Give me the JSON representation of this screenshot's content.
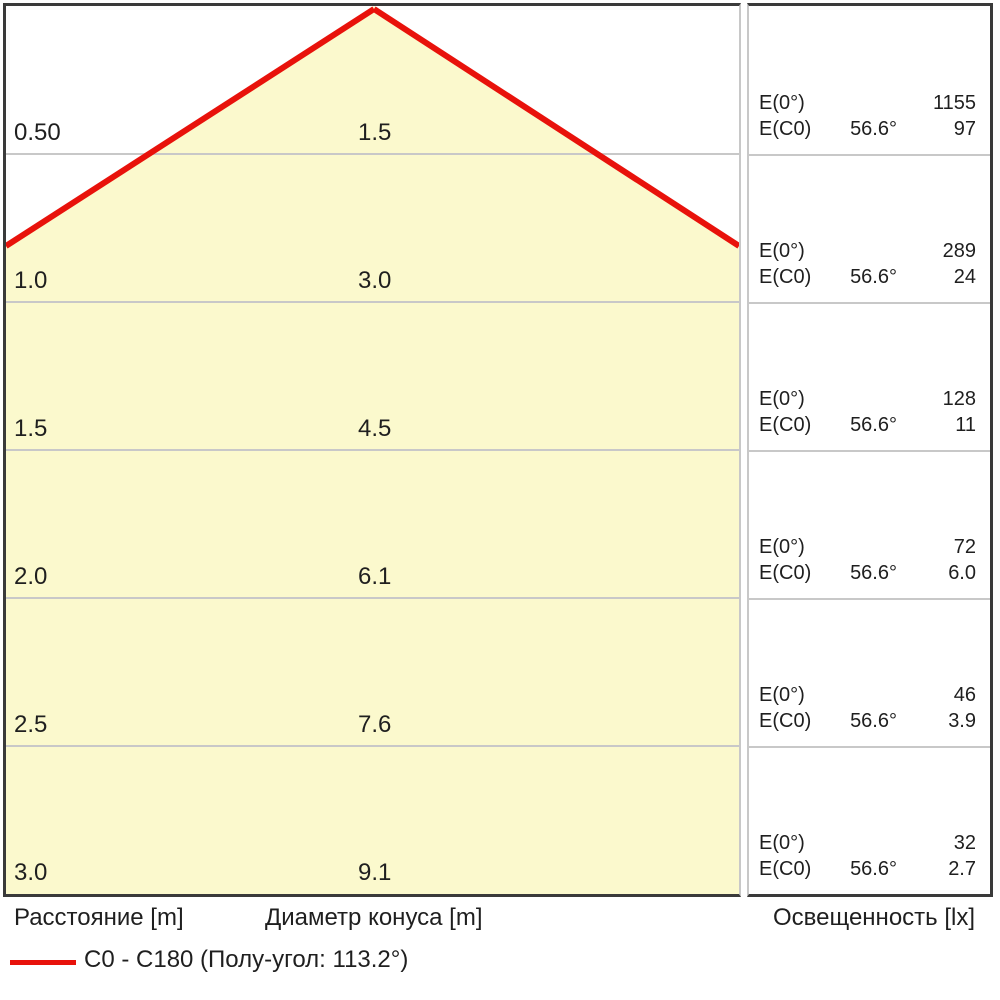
{
  "colors": {
    "cone_yellow": "#FBF9CD",
    "red": "#E8120B",
    "divider_gray": "#C8C8C8",
    "border_dark": "#3A3A3A",
    "text": "#1F1F1F"
  },
  "table": {
    "rows": [
      {
        "distance": "0.50",
        "diameter": "1.5",
        "e0_label": "E(0°)",
        "e0_value": "1155",
        "ec0_label": "E(C0)",
        "angle": "56.6°",
        "ec0_value": "97"
      },
      {
        "distance": "1.0",
        "diameter": "3.0",
        "e0_label": "E(0°)",
        "e0_value": "289",
        "ec0_label": "E(C0)",
        "angle": "56.6°",
        "ec0_value": "24"
      },
      {
        "distance": "1.5",
        "diameter": "4.5",
        "e0_label": "E(0°)",
        "e0_value": "128",
        "ec0_label": "E(C0)",
        "angle": "56.6°",
        "ec0_value": "11"
      },
      {
        "distance": "2.0",
        "diameter": "6.1",
        "e0_label": "E(0°)",
        "e0_value": "72",
        "ec0_label": "E(C0)",
        "angle": "56.6°",
        "ec0_value": "6.0"
      },
      {
        "distance": "2.5",
        "diameter": "7.6",
        "e0_label": "E(0°)",
        "e0_value": "46",
        "ec0_label": "E(C0)",
        "angle": "56.6°",
        "ec0_value": "3.9"
      },
      {
        "distance": "3.0",
        "diameter": "9.1",
        "e0_label": "E(0°)",
        "e0_value": "32",
        "ec0_label": "E(C0)",
        "angle": "56.6°",
        "ec0_value": "2.7"
      }
    ]
  },
  "footer": {
    "distance_label": "Расстояние [m]",
    "diameter_label": "Диаметр конуса [m]",
    "illuminance_label": "Освещенность [lx]"
  },
  "legend": {
    "label": "C0 - C180 (Полу-угол: 113.2°)"
  },
  "chart_data": {
    "type": "table",
    "subtype": "light-cone-diagram",
    "columns": [
      "Расстояние [m]",
      "Диаметр конуса [m]",
      "Освещенность [lx] E(0°)",
      "Освещенность [lx] E(C0) @ 56.6°"
    ],
    "rows": [
      [
        "0.50",
        "1.5",
        "1155",
        "97"
      ],
      [
        "1.0",
        "3.0",
        "289",
        "24"
      ],
      [
        "1.5",
        "4.5",
        "128",
        "11"
      ],
      [
        "2.0",
        "6.1",
        "72",
        "6.0"
      ],
      [
        "2.5",
        "7.6",
        "46",
        "3.9"
      ],
      [
        "3.0",
        "9.1",
        "32",
        "2.7"
      ]
    ],
    "ec0_angle": "56.6°",
    "half_angle": "113.2°",
    "legend_entry": "C0 - C180 (Полу-угол: 113.2°)",
    "legend_color": "#E8120B",
    "cone_fill_color": "#FBF9CD",
    "grid": "horizontal row dividers, gray",
    "legend_position": "bottom-left"
  }
}
